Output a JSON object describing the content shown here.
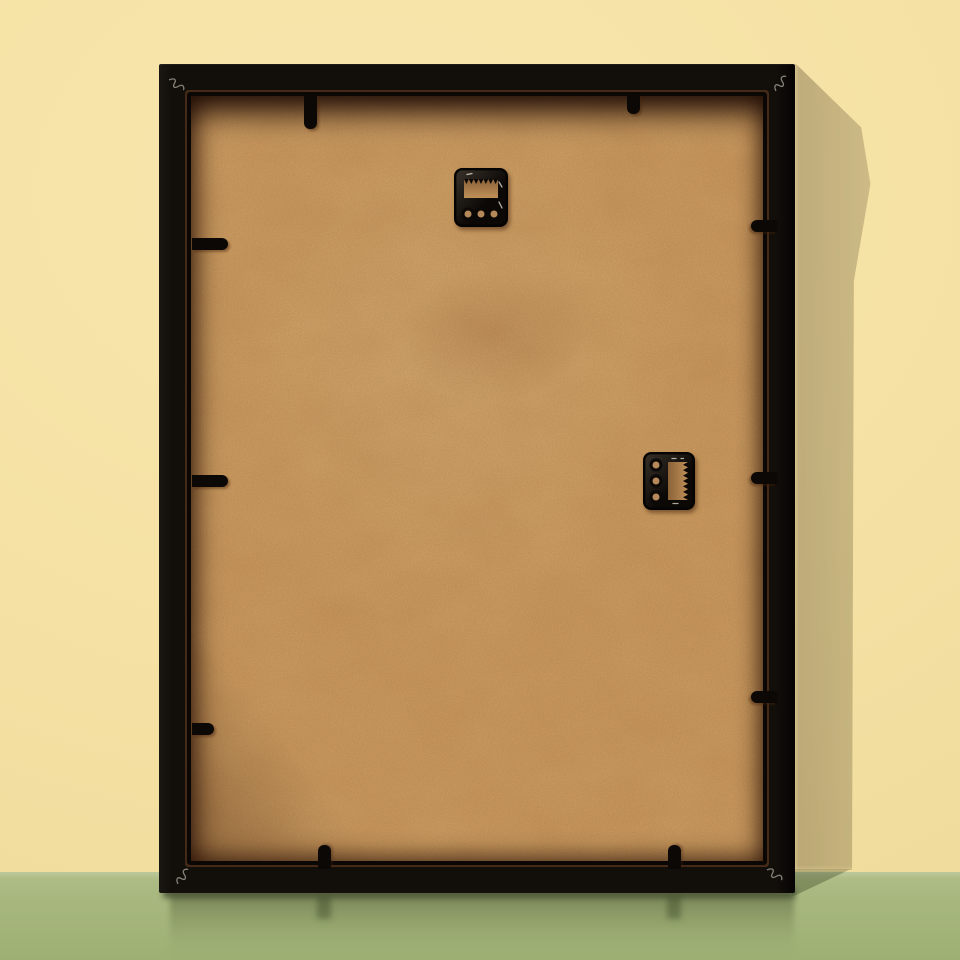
{
  "scene": {
    "type": "product-photo",
    "subject": "back of a black picture frame leaning against a wall",
    "hardware_counts": {
      "sawtooth_hangers": 2,
      "retainer_tabs": 8,
      "corner_fastener_marks": 4
    }
  },
  "colors": {
    "wall": "#f5e1a3",
    "wall_light": "#f7e6ad",
    "floor": "#a7b77e",
    "floor_haze": "#bdc89b",
    "frame": "#120e0a",
    "board": "#d0a267",
    "hardware": "#0b0806",
    "hole": "#b6895a",
    "glint": "#efe9dc",
    "vnail": "#9b948a"
  }
}
